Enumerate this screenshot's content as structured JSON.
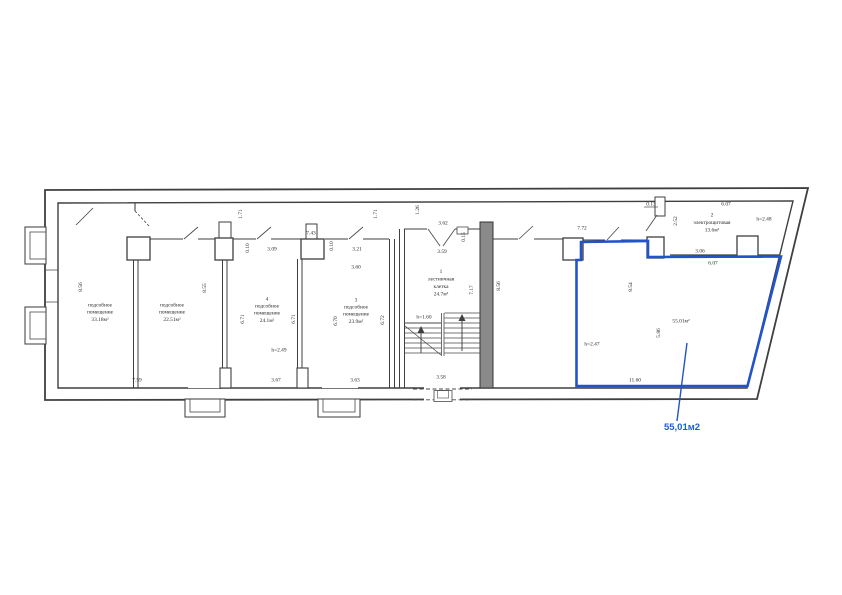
{
  "colors": {
    "highlight_blue": "#2353cb",
    "callout_blue": "#1d5fd6",
    "ink": "#3f3f3f"
  },
  "rooms": {
    "storage_a": {
      "name_line1": "подсобное",
      "name_line2": "помещение",
      "area": "33.18м²"
    },
    "storage_b": {
      "name_line1": "подсобное",
      "name_line2": "помещение",
      "area": "22.51м²"
    },
    "storage_4": {
      "number": "4",
      "name_line1": "подсобное",
      "name_line2": "помещение",
      "area": "24.1м²",
      "height": "h=2.49"
    },
    "storage_3": {
      "number": "3",
      "name_line1": "подсобное",
      "name_line2": "помещение",
      "area": "23.9м²"
    },
    "stairwell": {
      "number": "1",
      "name_line1": "лестничная",
      "name_line2": "клетка",
      "area": "24.7м²",
      "stair_height": "h=1.60"
    },
    "electrical": {
      "number": "2",
      "name": "электрощитовая",
      "area": "13.6м²",
      "height": "h=2.48"
    },
    "highlighted": {
      "area": "55.01м²",
      "height": "h=2.47",
      "callout": "55,01м2"
    }
  },
  "dims": {
    "d_856_left": "8.56",
    "d_759": "7.59",
    "d_171_a": "1.71",
    "d_855": "8.55",
    "d_010_a": "0.10",
    "d_309": "3.09",
    "d_671_a": "6.71",
    "d_743": "7.43",
    "d_367": "3.67",
    "d_671_b": "6.71",
    "d_010_b": "0.10",
    "d_321": "3.21",
    "d_360": "3.60",
    "d_670": "6.70",
    "d_363": "3.63",
    "d_672": "6.72",
    "d_171_b": "1.71",
    "d_126": "1.26",
    "d_362": "3.62",
    "d_359": "3.59",
    "d_015": "0.15",
    "d_717": "7.17",
    "d_358": "3.58",
    "d_856_mid": "8.56",
    "d_772": "7.72",
    "d_013": "0.13",
    "d_252": "2.52",
    "d_607_top": "6.07",
    "d_306": "3.06",
    "d_607_mid": "6.07",
    "d_854": "8.54",
    "d_586": "5.86",
    "d_1160": "11.60"
  }
}
